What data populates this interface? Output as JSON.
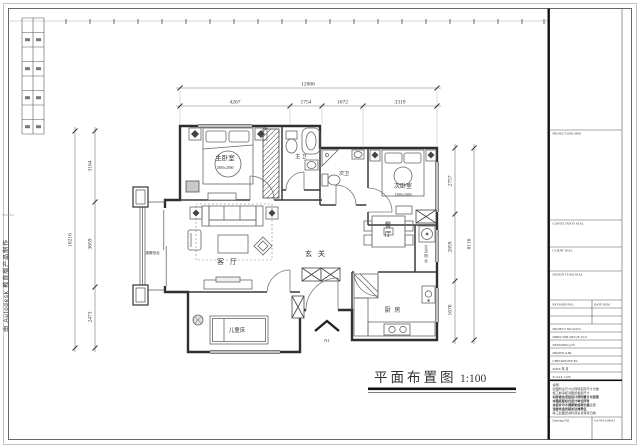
{
  "page": {
    "watermark_left": "由 Autodesk 教育版产品制作",
    "drawing_title": "平面布置图",
    "drawing_scale": "1:100"
  },
  "dims": {
    "top_total": "12006",
    "top_segments": [
      "4267",
      "1754",
      "1672",
      "3319"
    ],
    "left_total": "10216",
    "left_segments": [
      "3164",
      "3659",
      "2473"
    ],
    "right_total": "8116",
    "right_segments": [
      "2757",
      "2859",
      "1670"
    ]
  },
  "rooms": {
    "master_bedroom": "主卧室",
    "master_bedroom_size": "1800x2000",
    "master_bath": "主 卫",
    "second_bath": "次卫",
    "second_bedroom": "次卧室",
    "second_bedroom_size": "1500x2000",
    "living_room": "客 厅",
    "foyer": "玄 关",
    "dining": "餐厅",
    "kitchen": "厨 房",
    "kids_bed": "儿童床",
    "service_balcony": "生活阳台",
    "view_balcony": "观景阳台",
    "entry_mark": "N1"
  },
  "titleblock": {
    "top_label": "PROJECT/2F02  0908",
    "section1_label": "CONSULTANTS  SEAL",
    "section2_label": "CLIENT  SEAL",
    "section3_label": "DESIGN TEAM  SEAL",
    "rev_no_label": "REVISION NO.",
    "rev_date_label": "DATE REM",
    "project_no": "PROJECT NO   A2013",
    "director": "DIRECTOR-DES   2F-25-0",
    "designed": "DESIGNED   p.05",
    "drawn": "DRAWN   A.BL",
    "checked": "CHECKED BY   B.L",
    "date_row": "DATE        年  月",
    "scale_row": "SCALE       1:100",
    "notes": [
      "说明:",
      "此图所注尺寸以现场实际尺寸为准",
      "施工前请核对图纸各部尺寸",
      "如有修改须经设计师同意方可变更",
      "本图纸版权归设计单位所有",
      "未经许可不得复制或转交第三方",
      "违者将追究相关法律责任",
      "竣工后图纸资料须妥善保存归档"
    ],
    "drawing_no_label": "Drawing NO",
    "job_no_label": "Job NO  0206A3"
  }
}
